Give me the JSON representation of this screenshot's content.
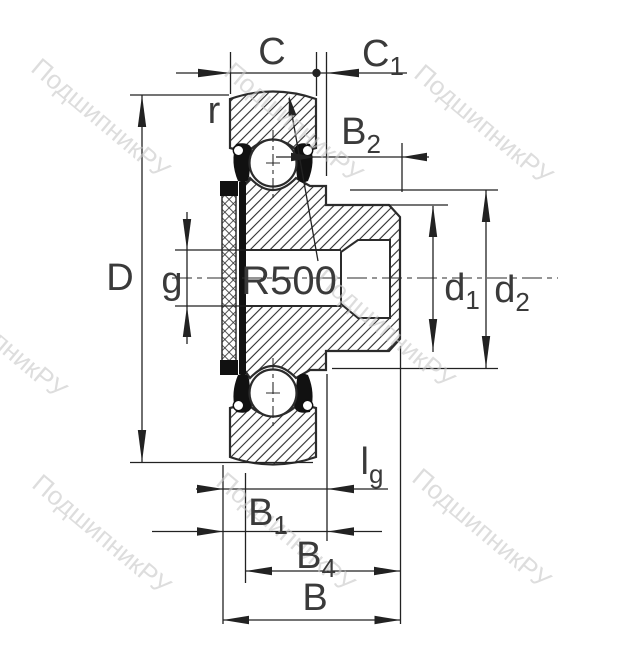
{
  "drawing": {
    "title_hint": "flanged insert ball bearing cross-section",
    "radius_annotation": "R500",
    "labels": {
      "C": {
        "base": "C",
        "sub": ""
      },
      "C1": {
        "base": "C",
        "sub": "1"
      },
      "r": {
        "base": "r",
        "sub": ""
      },
      "B2": {
        "base": "B",
        "sub": "2"
      },
      "D": {
        "base": "D",
        "sub": ""
      },
      "g": {
        "base": "g",
        "sub": ""
      },
      "d1": {
        "base": "d",
        "sub": "1"
      },
      "d2": {
        "base": "d",
        "sub": "2"
      },
      "lg": {
        "base": "l",
        "sub": "g"
      },
      "B1": {
        "base": "B",
        "sub": "1"
      },
      "B4": {
        "base": "B",
        "sub": "4"
      },
      "B": {
        "base": "B",
        "sub": ""
      }
    }
  },
  "watermark": {
    "text": "ПодшипникРУ"
  },
  "colors": {
    "line": "#2b2b2b",
    "dimension": "#222222",
    "label": "#3a3a3a",
    "seal": "#111111",
    "watermark": "#c8c8c8",
    "background": "#ffffff"
  }
}
